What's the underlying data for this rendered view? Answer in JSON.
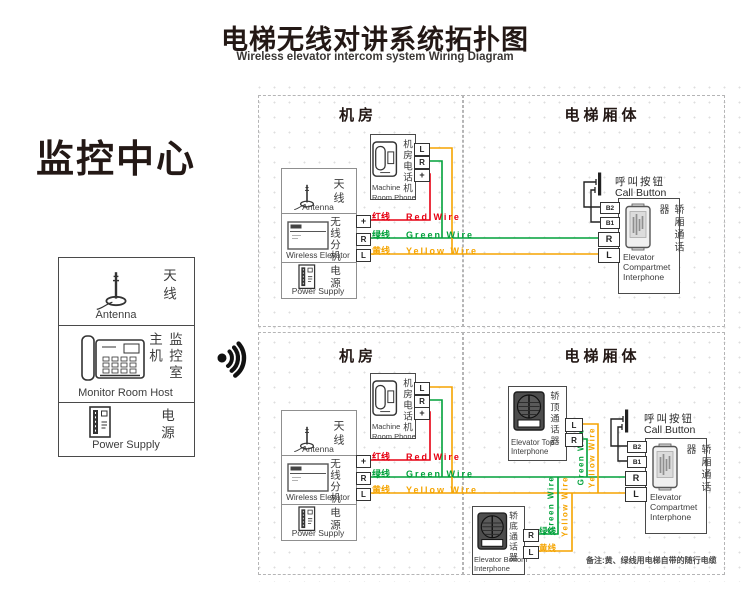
{
  "page": {
    "title_zh": "电梯无线对讲系统拓扑图",
    "title_en": "Wireless elevator intercom system Wiring Diagram",
    "note": "备注:黄、绿线用电梯自带的随行电缆"
  },
  "monitor_center": {
    "heading": "监控中心",
    "antenna_zh": "天线",
    "antenna_en": "Antenna",
    "host_zh": "监控室主机",
    "host_en": "Monitor Room Host",
    "power_zh": "电源",
    "power_en": "Power Supply"
  },
  "sections": {
    "machine_room": "机房",
    "elevator_car": "电梯厢体"
  },
  "machine_room_phone": {
    "zh": "机房电话机",
    "en_line1": "Machine",
    "en_line2": "Room Phone"
  },
  "wireless_box": {
    "antenna_zh": "天线",
    "antenna_en": "Antenna",
    "unit_zh": "无线分机",
    "unit_en": "Wireless Elevator",
    "power_zh": "电源",
    "power_en": "Power Supply"
  },
  "wires": {
    "red_zh": "红线",
    "red_en": "Red Wire",
    "red_color": "#e60012",
    "green_zh": "绿线",
    "green_en": "Green Wire",
    "green_color": "#00a13a",
    "yellow_zh": "黄线",
    "yellow_en": "Yellow Wire",
    "yellow_color": "#f5a400",
    "green_vertical": "Green Wire",
    "yellow_vertical": "Yellow Wire"
  },
  "call_button": {
    "zh": "呼叫按钮",
    "en": "Call Button"
  },
  "interphones": {
    "compartment_zh": "轿厢通话器",
    "compartment_en1": "Elevator",
    "compartment_en2": "Compartmet",
    "compartment_en3": "Interphone",
    "top_zh": "轿顶通话器",
    "top_en1": "Elevator Top",
    "top_en2": "Interphone",
    "bottom_zh": "轿底通话器",
    "bottom_en1": "Elevator Bottom",
    "bottom_en2": "Interphone"
  },
  "terminals": {
    "L": "L",
    "R": "R",
    "plus": "+",
    "B1": "B1",
    "B2": "B2"
  }
}
